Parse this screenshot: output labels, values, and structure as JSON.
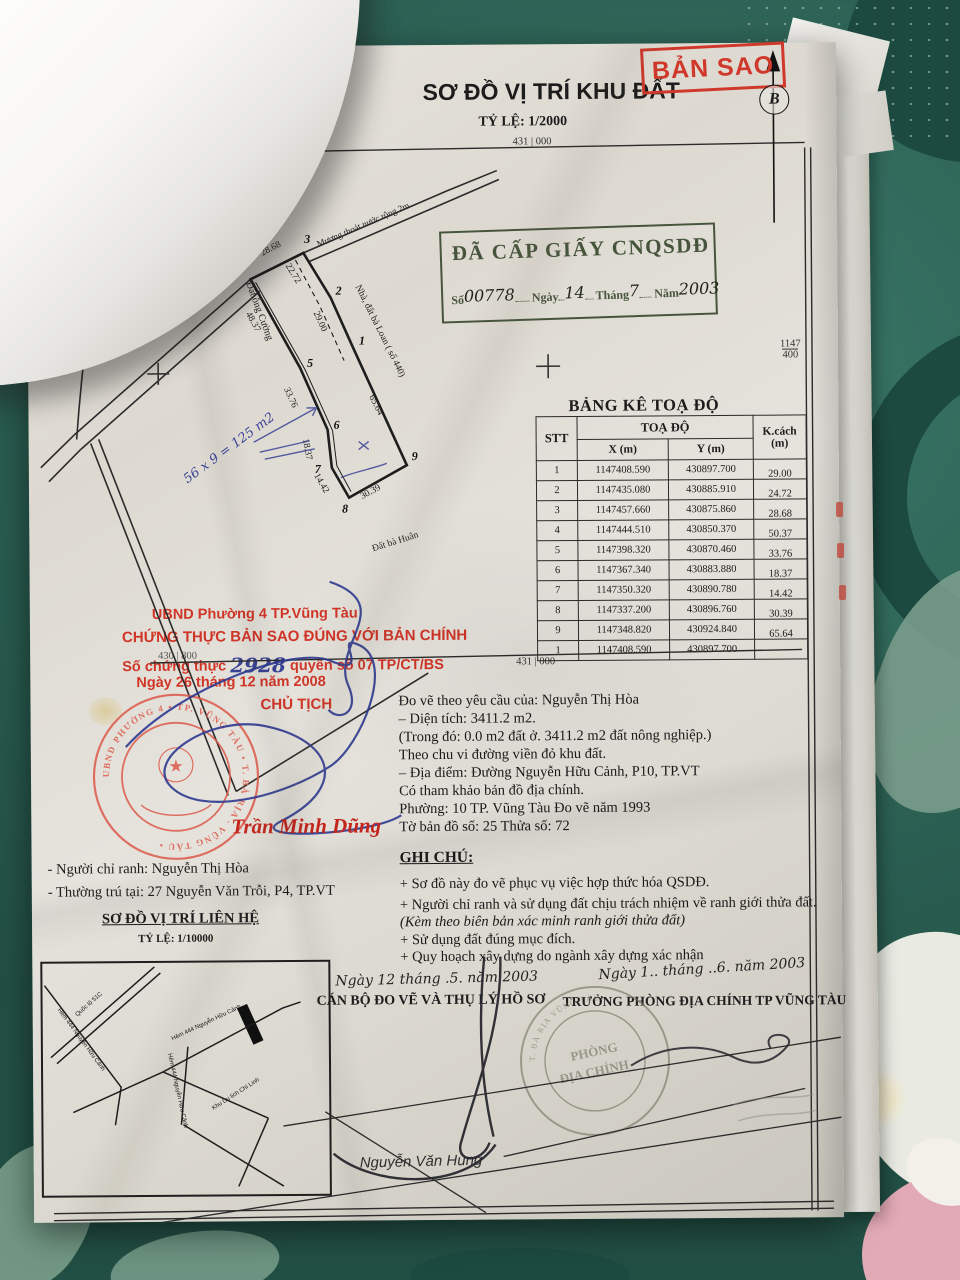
{
  "header": {
    "org1": "ố Vũng Tàu",
    "org2": "G ĐỊA CHÍNH",
    "title": "SƠ ĐỒ VỊ TRÍ KHU ĐẤT",
    "scale": "TỶ LỆ:  1/2000",
    "copy_stamp": "BẢN SAO",
    "north": "B"
  },
  "grid": {
    "top_left": "430 | 800",
    "top_center": "431 | 000",
    "bottom_left": "430 | 800",
    "bottom_center": "431 | 000",
    "right_num": "1147",
    "right_den": "400",
    "left_num": "1147",
    "left_den": "400"
  },
  "issue_stamp": {
    "title": "ĐÃ CẤP GIẤY CNQSDĐ",
    "f1": "Số",
    "v1": "00778",
    "f2": "Ngày",
    "v2": "14",
    "f3": "Tháng",
    "v3": "7",
    "f4": "Năm",
    "v4": "2003"
  },
  "map": {
    "road": "Đường Nguyễn Hữu Cảnh",
    "east": "E",
    "canal": "Mương thoát nước rộng 2m",
    "nb_right": "Nhà, đất bà Loan ( số 440)",
    "nb_left": "Đất ông Cường",
    "nb_bottom": "Đất bà Huân",
    "note_blue": "56 x 9 = 125 m2",
    "v1": "1",
    "v2": "2",
    "v3": "3",
    "v4": "4",
    "v5": "5",
    "v6": "6",
    "v7": "7",
    "v8": "8",
    "v9": "9",
    "e43": "28.68",
    "e32": "22.72",
    "e21": "29.00",
    "e45": "48.37",
    "e56": "33.76",
    "e67": "18.37",
    "e78": "14.42",
    "e89": "30.39",
    "e91": "65.64"
  },
  "table": {
    "title": "BẢNG KÊ TOẠ ĐỘ",
    "h_stt": "STT",
    "h_toado": "TOẠ ĐỘ",
    "h_x": "X (m)",
    "h_y": "Y (m)",
    "h_k1": "K.cách",
    "h_k2": "(m)",
    "rows": [
      {
        "stt": "1",
        "x": "1147408.590",
        "y": "430897.700",
        "k": "29.00"
      },
      {
        "stt": "2",
        "x": "1147435.080",
        "y": "430885.910",
        "k": "24.72"
      },
      {
        "stt": "3",
        "x": "1147457.660",
        "y": "430875.860",
        "k": "28.68"
      },
      {
        "stt": "4",
        "x": "1147444.510",
        "y": "430850.370",
        "k": "50.37"
      },
      {
        "stt": "5",
        "x": "1147398.320",
        "y": "430870.460",
        "k": "33.76"
      },
      {
        "stt": "6",
        "x": "1147367.340",
        "y": "430883.880",
        "k": "18.37"
      },
      {
        "stt": "7",
        "x": "1147350.320",
        "y": "430890.780",
        "k": "14.42"
      },
      {
        "stt": "8",
        "x": "1147337.200",
        "y": "430896.760",
        "k": "30.39"
      },
      {
        "stt": "9",
        "x": "1147348.820",
        "y": "430924.840",
        "k": "65.64"
      },
      {
        "stt": "1",
        "x": "1147408.590",
        "y": "430897.700",
        "k": ""
      }
    ]
  },
  "certify": {
    "l1": "UBND Phường 4 TP.Vũng Tàu",
    "l2": "CHỨNG THỰC BẢN SAO ĐÚNG VỚI BẢN CHÍNH",
    "l3a": "Số chứng thực",
    "l3_hand": "2928",
    "l3b": "quyển số 07  TP/CT/BS",
    "l4": "Ngày   26  tháng  12  năm  2008",
    "l5": "CHỦ TỊCH",
    "signer": "Trần Minh Dũng",
    "seal_ring": "UBND PHƯỜNG 4 • TP. VŨNG TÀU • T. BÀ RỊA - VŨNG TÀU •",
    "seal_star": "★"
  },
  "info": {
    "l1": "Đo vẽ theo yêu cầu của:   Nguyễn Thị Hòa",
    "l2": "– Diện tích:  3411.2 m2.",
    "l3": "   (Trong đó:    0.0 m2 đất ở.      3411.2 m2 đất nông nghiệp.)",
    "l4": "Theo chu vi đường viền đỏ khu đất.",
    "l5": "– Địa điểm:  Đường Nguyễn Hữu Cảnh, P10, TP.VT",
    "l6": "Có tham khảo bản đồ địa chính.",
    "l7": "Phường:    10     TP. Vũng Tàu              Đo vẽ năm 1993",
    "l8": "Tờ bản đồ số:  25        Thửa số:    72"
  },
  "notes": {
    "title": "GHI CHÚ:",
    "n1": "+ Sơ đồ này đo vẽ phục vụ việc hợp thức hóa QSDĐ.",
    "n2": "+ Người chỉ ranh và sử dụng đất chịu trách nhiệm về ranh giới thửa đất.",
    "n3": "(Kèm theo biên bản xác minh ranh giới thửa đất)",
    "n4": "+ Sử dụng đất đúng mục đích.",
    "n5": "+ Quy hoạch xây dựng do ngành xây dựng xác nhận"
  },
  "contact": {
    "l1": "- Người chỉ ranh:  Nguyễn Thị Hòa",
    "l2": "- Thường trú tại:  27 Nguyễn Văn Trỗi, P4, TP.VT"
  },
  "inset": {
    "title": "SƠ ĐỒ VỊ TRÍ LIÊN HỆ",
    "scale": "TỶ LỆ:  1/10000",
    "r1": "Quốc lộ 51C",
    "r2": "Hẻm 444 Nguyễn Hữu Cảnh",
    "r3": "Hẻm 444 Nguyễn Hữu Cảnh",
    "r4": "Hẻm 444 Nguyễn Hữu Cảnh",
    "r5": "Khu Du lịch Chí Linh"
  },
  "sign_left": {
    "date": "Ngày 12 tháng .5. năm 2003",
    "title": "CÁN BỘ ĐO VẼ VÀ THỤ LÝ HỒ SƠ"
  },
  "sign_right": {
    "date": "Ngày 1.. tháng ..6. năm 2003",
    "title": "TRƯỞNG PHÒNG ĐỊA CHÍNH TP VŨNG TÀU",
    "stamp1": "PHÒNG",
    "stamp2": "ĐỊA CHÍNH",
    "stamp_ring": "T. BÀ RỊA VŨNG TÀU"
  },
  "footer": {
    "name": "Nguyễn Văn Hùng"
  }
}
